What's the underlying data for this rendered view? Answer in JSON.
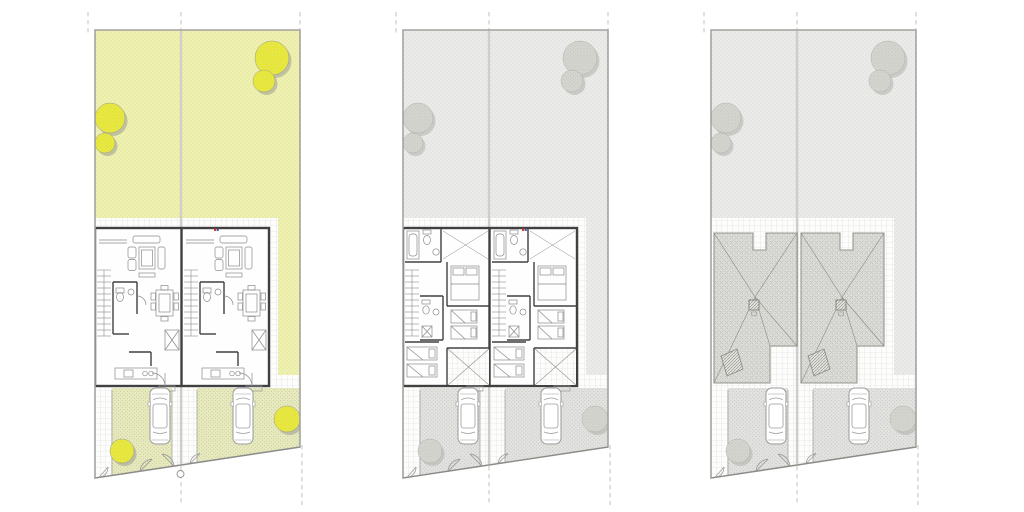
{
  "scene": {
    "description": "Three aligned architectural site plans of a semi-detached twin house plot: ground floor with yellow-green garden, upper floor in grayscale, and roof plan in grayscale.",
    "background": "#ffffff",
    "panels": [
      {
        "id": "plan-ground",
        "name": "ground-floor-site-plan",
        "floor": "ground",
        "palette": {
          "garden": "#eef1b2",
          "garden_dot": "#d2d87c",
          "tree": "#e5e538",
          "tree_speck": "#f2f28c",
          "tree_shadow": "#9a9a92",
          "drive": "#e8eac2",
          "drive_dot": "#c7cb8a",
          "grid_line": "#dadada",
          "boundary": "#a3a3a0",
          "divider": "#b4b4b0",
          "wall": "#404040",
          "furn": "#8a8a8a",
          "line": "#9b9b9b",
          "accent_red": "#cc3322",
          "accent_blue": "#3355cc",
          "roof": "#dcdcd8",
          "roof_dot": "#a6a6a1",
          "roof_line": "#c2c2be"
        }
      },
      {
        "id": "plan-upper",
        "name": "upper-floor-site-plan",
        "floor": "upper",
        "palette": {
          "garden": "#ebebe9",
          "garden_dot": "#cfcfcb",
          "tree": "#d5d5d0",
          "tree_speck": "#b9b9b2",
          "tree_shadow": "#b0b0ab",
          "drive": "#e3e3e1",
          "drive_dot": "#c3c3bf",
          "grid_line": "#dadada",
          "boundary": "#a3a3a0",
          "divider": "#b4b4b0",
          "wall": "#404040",
          "furn": "#8a8a8a",
          "line": "#9b9b9b",
          "accent_red": "#cc3322",
          "accent_blue": "#3355cc",
          "roof": "#dcdcd8",
          "roof_dot": "#a6a6a1",
          "roof_line": "#c2c2be"
        }
      },
      {
        "id": "plan-roof",
        "name": "roof-site-plan",
        "floor": "roof",
        "palette": {
          "garden": "#ebebe9",
          "garden_dot": "#cfcfcb",
          "tree": "#d5d5d0",
          "tree_speck": "#b9b9b2",
          "tree_shadow": "#b0b0ab",
          "drive": "#e3e3e1",
          "drive_dot": "#c3c3bf",
          "grid_line": "#dadada",
          "boundary": "#a3a3a0",
          "divider": "#b4b4b0",
          "wall": "#404040",
          "furn": "#8a8a8a",
          "line": "#9b9b9b",
          "accent_red": "#cc3322",
          "accent_blue": "#3355cc",
          "roof": "#dcdcd8",
          "roof_dot": "#a6a6a1",
          "roof_line": "#c2c2be"
        }
      }
    ],
    "shared": {
      "units_per_plot": 2,
      "tree_clusters": [
        {
          "x": 194,
          "y": 58,
          "r": 17
        },
        {
          "x": 186,
          "y": 81,
          "r": 11
        },
        {
          "x": 32,
          "y": 118,
          "r": 15
        },
        {
          "x": 27,
          "y": 143,
          "r": 10
        },
        {
          "x": 44,
          "y": 451,
          "r": 12
        },
        {
          "x": 209,
          "y": 419,
          "r": 13
        }
      ],
      "cars": [
        {
          "x": 82,
          "y": 416
        },
        {
          "x": 165,
          "y": 416
        }
      ],
      "level_marker": {
        "x": 102.5,
        "y": 474,
        "r": 3.5,
        "panel": "plan-ground"
      }
    }
  }
}
